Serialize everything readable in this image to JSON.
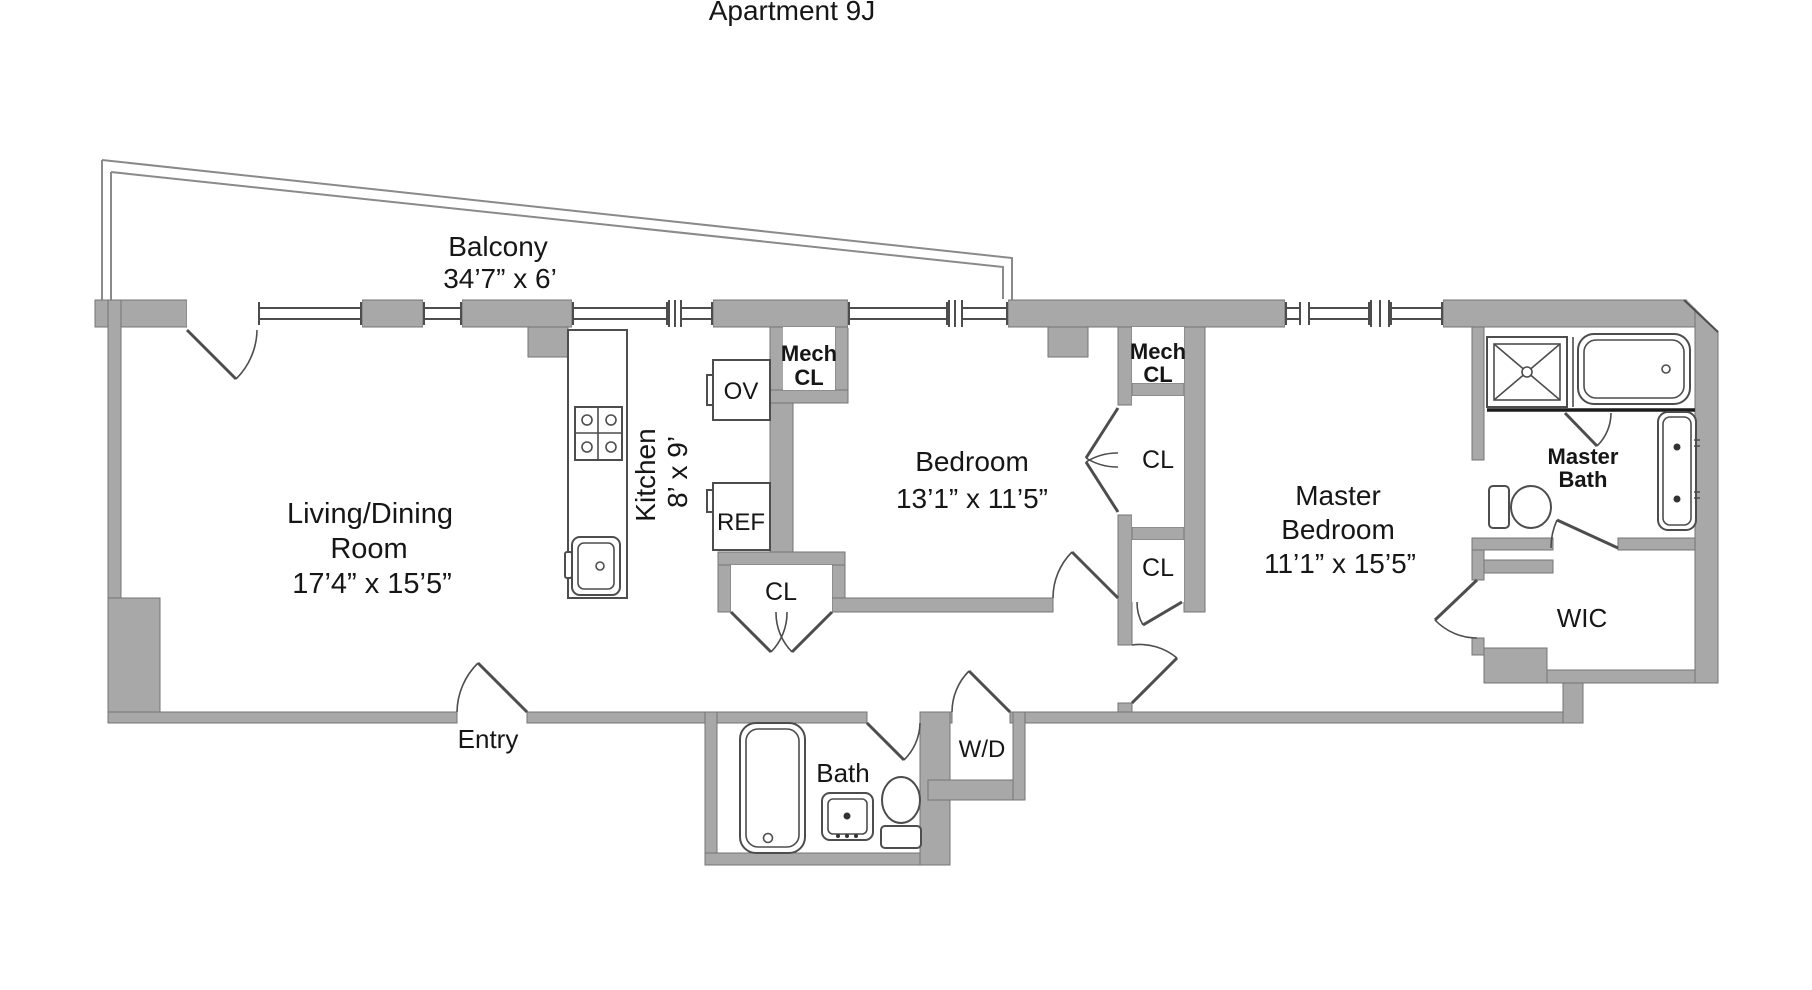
{
  "title": "Apartment 9J",
  "colors": {
    "wall_fill": "#a8a8a8",
    "wall_stroke": "#757575",
    "line": "#4d4d4d",
    "text": "#161616",
    "background": "#ffffff"
  },
  "rooms": {
    "balcony": {
      "name": "Balcony",
      "dims": "34’7” x 6’"
    },
    "living_dining": {
      "line1": "Living/Dining",
      "line2": "Room",
      "dims": "17’4” x 15’5”"
    },
    "kitchen": {
      "name": "Kitchen",
      "dims": "8’ x 9’"
    },
    "bedroom": {
      "name": "Bedroom",
      "dims": "13’1” x 11’5”"
    },
    "master_bedroom": {
      "line1": "Master",
      "line2": "Bedroom",
      "dims": "11’1” x 15’5”"
    },
    "master_bath": {
      "line1": "Master",
      "line2": "Bath"
    },
    "bath": {
      "name": "Bath"
    },
    "wic": {
      "name": "WIC"
    },
    "entry": {
      "name": "Entry"
    },
    "laundry": {
      "name": "W/D"
    },
    "mech_closet_kitchen": {
      "line1": "Mech",
      "line2": "CL"
    },
    "mech_closet_master": {
      "line1": "Mech",
      "line2": "CL"
    },
    "closet_hall": {
      "name": "CL"
    },
    "closet_bedroom": {
      "name": "CL"
    },
    "closet_master_hall": {
      "name": "CL"
    },
    "appliance_oven": {
      "name": "OV"
    },
    "appliance_fridge": {
      "name": "REF"
    }
  }
}
